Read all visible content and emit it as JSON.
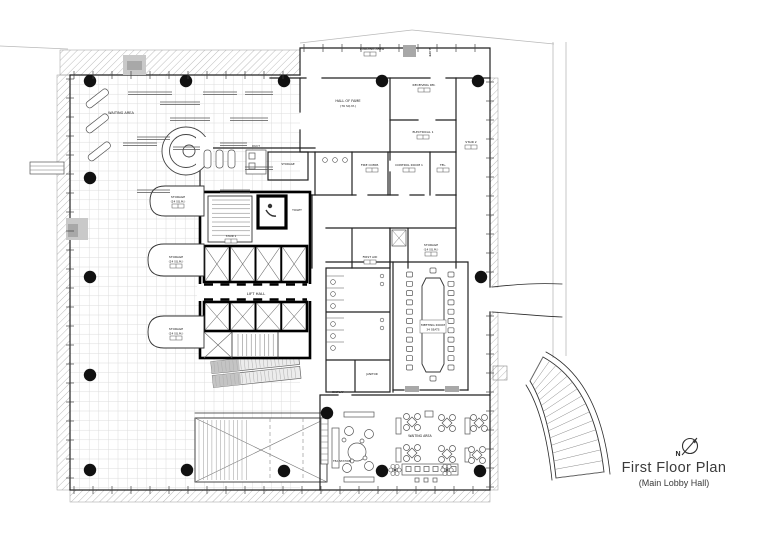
{
  "title_block": {
    "title": "First Floor Plan",
    "subtitle": "(Main Lobby Hall)",
    "north_label": "N"
  },
  "colors": {
    "line": "#222222",
    "grid": "#d9d9d9",
    "hatch": "#bdbdbd",
    "gray_fill": "#c9c9c9",
    "column_fill": "#111111"
  },
  "labels": {
    "waiting_area_upper": "WAITING AREA",
    "hall_of_fame": "HALL OF FAME",
    "hall_of_fame_area": "(76 SQ.M.)",
    "loading_area": "LOADING AREA",
    "slope": "SLOPE",
    "receiving_rm": "RECEIVING RM.",
    "electrical": "ELECTRICAL 1",
    "stair_2": "STAIR 2",
    "fire_comm": "FIRE COMM.",
    "control_room": "CONTROL ROOM 1",
    "tel": "TEL.",
    "duct": "DUCT",
    "storage_lobby": "STORAGE",
    "storage_1": "STORAGE",
    "storage_1_area": "(24 SQ.M.)",
    "storage_2": "STORAGE",
    "storage_2_area": "(24 SQ.M.)",
    "storage_3": "STORAGE",
    "storage_3_area": "(24 SQ.M.)",
    "stair_1": "STAIR 1",
    "toilet": "TOILET",
    "lift_hall": "LIFT HALL",
    "first_aid": "FIRST AID",
    "storage_service": "STORAGE",
    "storage_service_area": "(14 SQ.M.)",
    "janitor": "JANITOR",
    "meeting_room": "MEETING ROOM",
    "meeting_room_seats": "34 SEATS",
    "display": "DISPLAY",
    "waiting_area_lower": "WAITING AREA",
    "tea_station": "TEA STATION"
  }
}
